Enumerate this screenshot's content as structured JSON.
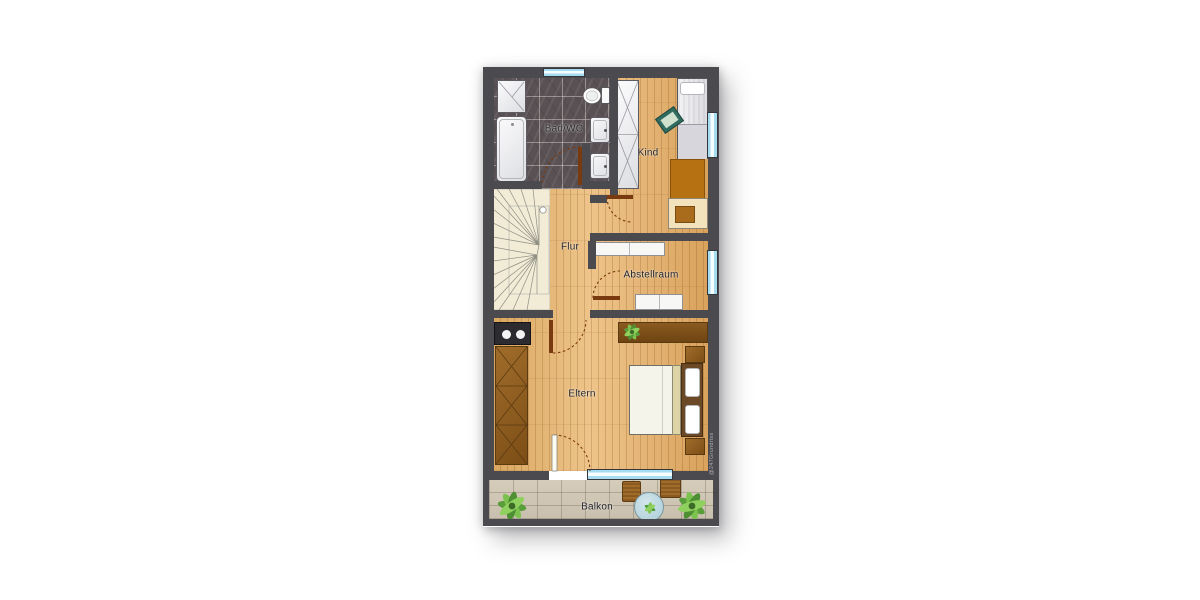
{
  "watermark": "@247Grundriss",
  "rooms": {
    "bad": "Bad/WC",
    "kind": "Kind",
    "flur": "Flur",
    "abstellraum": "Abstellraum",
    "eltern": "Eltern",
    "balkon": "Balkon"
  },
  "colors": {
    "wall": "#4b4b4f",
    "wood_floor": "#e3b272",
    "bath_floor": "#5a5154",
    "stairs": "#f2ebd6",
    "window_glass": "#a5dcef",
    "balcony_floor": "#cfc5b2",
    "furniture_brown": "#8a5a1e",
    "door_leaf": "#7a3a10",
    "label_text": "#222226",
    "plant_green": "#6fb24a"
  },
  "furniture_icons": [
    "shower-icon",
    "bathtub-icon",
    "toilet-icon",
    "sink-icon",
    "wardrobe-icon",
    "bed-icon",
    "pillow-icon",
    "cushion-icon",
    "rug-icon",
    "desk-icon",
    "chair-icon",
    "shelf-icon",
    "staircase-icon",
    "sideboard-icon",
    "plant-icon",
    "double-bed-icon",
    "nightstand-icon",
    "dresser-icon",
    "balcony-table-icon",
    "balcony-chair-icon",
    "window-icon",
    "door-icon"
  ]
}
